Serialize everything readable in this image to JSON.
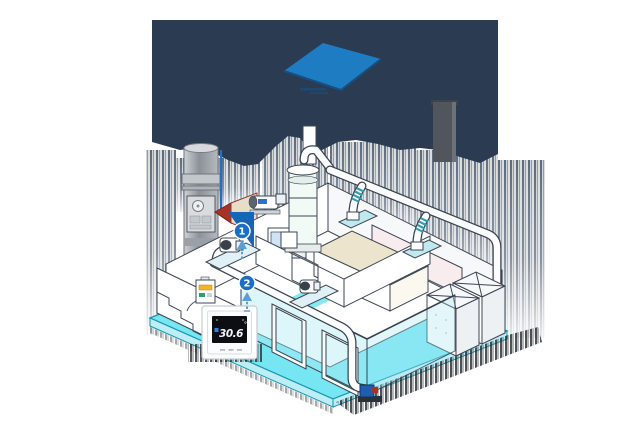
{
  "colors": {
    "silhouette": "#2b3c52",
    "roof_panel": "#1e7dc2",
    "hotspot_badge": "#1a6fc4",
    "hotspot_wedge": "#1565b8",
    "floor": "#76e7f2",
    "floor_side": "#bdeef5",
    "bench": "#ece4cc",
    "alert_red": "#a93226",
    "horn_beige": "#e8ddc8",
    "coupling": "#2e9db5",
    "screen_bg": "#0c0e13",
    "screen_text": "#f2f5fa",
    "pump_blue": "#1d5fae"
  },
  "hotspots": [
    {
      "label": "1"
    },
    {
      "label": "2"
    }
  ],
  "thermostat": {
    "temperature": "30.6",
    "unit": "°"
  }
}
